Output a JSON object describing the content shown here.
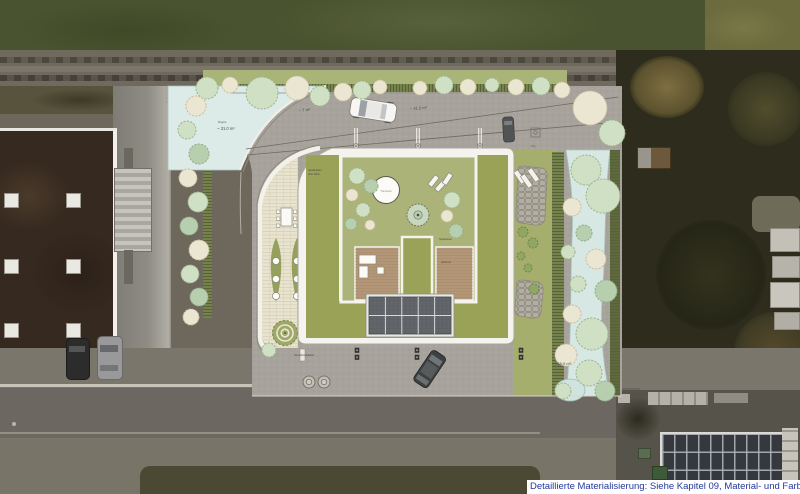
{
  "caption": {
    "text": "Detaillierte Materialisierung: Siehe Kapitel 09, Material- und Farbkonzept"
  },
  "labels": {
    "infiltration_name": "Rigole",
    "infiltration_area": "~ 31.0 m²",
    "area_left": "~ 7 m²",
    "area_right": "~ 41.5 m²",
    "area_east": "~ 18.0 m²",
    "trampoline": "Trampolin",
    "sandpit_line1": "Sandkasten",
    "sandpit_line2": "über Dach",
    "lawn": "Spielwiese",
    "deck": "Holzrost",
    "bike": "Veloabstellplätze",
    "hydrant": "Wa"
  },
  "colors": {
    "plan_asphalt": "#a7a39c",
    "green_roof": "#9aa257",
    "courtyard_lawn": "#abb378",
    "roof_white": "#f4f3ee",
    "infiltration_blue": "#d9e9e5",
    "terrace_cream": "#e9e4d0",
    "deck_wood": "#b29677",
    "hedge_green": "#76824b",
    "caption_blue": "#25379b",
    "tree": {
      "g": {
        "f": "#cfe0c4",
        "s": "#9db48e"
      },
      "c": {
        "f": "#ebe6d1",
        "s": "#c8bda0"
      },
      "m": {
        "f": "#b7cfae",
        "s": "#8fae85"
      },
      "s": {
        "f": "#8fa664",
        "s": "#6f8549"
      },
      "o": {
        "f": "#c3c0b6",
        "s": "#76736b"
      }
    }
  },
  "scene": {
    "trees": [
      [
        207,
        88,
        11,
        "g"
      ],
      [
        230,
        85,
        8,
        "c"
      ],
      [
        262,
        93,
        16,
        "g"
      ],
      [
        297,
        88,
        12,
        "c"
      ],
      [
        320,
        96,
        10,
        "g"
      ],
      [
        343,
        92,
        9,
        "c"
      ],
      [
        362,
        90,
        9,
        "g"
      ],
      [
        380,
        87,
        7,
        "c"
      ],
      [
        420,
        88,
        7,
        "c"
      ],
      [
        444,
        85,
        9,
        "g"
      ],
      [
        468,
        87,
        8,
        "c"
      ],
      [
        492,
        85,
        7,
        "g"
      ],
      [
        516,
        87,
        8,
        "c"
      ],
      [
        541,
        86,
        9,
        "g"
      ],
      [
        562,
        90,
        8,
        "c"
      ],
      [
        590,
        108,
        17,
        "c"
      ],
      [
        612,
        133,
        13,
        "g"
      ],
      [
        196,
        106,
        10,
        "c"
      ],
      [
        187,
        130,
        9,
        "g"
      ],
      [
        199,
        154,
        10,
        "m"
      ],
      [
        188,
        178,
        9,
        "c"
      ],
      [
        198,
        202,
        10,
        "g"
      ],
      [
        189,
        226,
        9,
        "m"
      ],
      [
        199,
        250,
        10,
        "c"
      ],
      [
        190,
        274,
        9,
        "g"
      ],
      [
        199,
        297,
        9,
        "m"
      ],
      [
        191,
        317,
        8,
        "c"
      ],
      [
        586,
        170,
        15,
        "g"
      ],
      [
        603,
        196,
        17,
        "g"
      ],
      [
        572,
        207,
        9,
        "c"
      ],
      [
        584,
        233,
        8,
        "m"
      ],
      [
        568,
        252,
        7,
        "g"
      ],
      [
        596,
        259,
        10,
        "c"
      ],
      [
        578,
        284,
        8,
        "g"
      ],
      [
        606,
        291,
        11,
        "m"
      ],
      [
        572,
        314,
        9,
        "c"
      ],
      [
        592,
        334,
        16,
        "g"
      ],
      [
        566,
        355,
        11,
        "c"
      ],
      [
        589,
        373,
        13,
        "g"
      ],
      [
        605,
        391,
        10,
        "m"
      ],
      [
        563,
        391,
        8,
        "g"
      ],
      [
        357,
        176,
        8,
        "g"
      ],
      [
        371,
        186,
        7,
        "m"
      ],
      [
        352,
        195,
        6,
        "c"
      ],
      [
        363,
        210,
        7,
        "g"
      ],
      [
        351,
        224,
        6,
        "m"
      ],
      [
        370,
        225,
        5,
        "c"
      ],
      [
        452,
        200,
        8,
        "g"
      ],
      [
        447,
        216,
        6,
        "c"
      ],
      [
        456,
        231,
        7,
        "m"
      ],
      [
        523,
        232,
        5,
        "s"
      ],
      [
        533,
        243,
        5,
        "s"
      ],
      [
        521,
        256,
        4,
        "s"
      ],
      [
        528,
        268,
        4,
        "s"
      ],
      [
        534,
        289,
        5,
        "s"
      ],
      [
        269,
        350,
        7,
        "g"
      ],
      [
        309,
        382,
        6,
        "o"
      ],
      [
        324,
        382,
        6,
        "o"
      ]
    ],
    "parking_dividers": [
      356,
      418,
      480
    ],
    "bollards_top": [
      356,
      418,
      480
    ],
    "bollards_bottom": [
      357,
      417,
      521
    ],
    "skylights": [
      [
        4,
        62
      ],
      [
        66,
        62
      ],
      [
        4,
        128
      ],
      [
        66,
        128
      ],
      [
        4,
        192
      ],
      [
        66,
        192
      ]
    ]
  }
}
